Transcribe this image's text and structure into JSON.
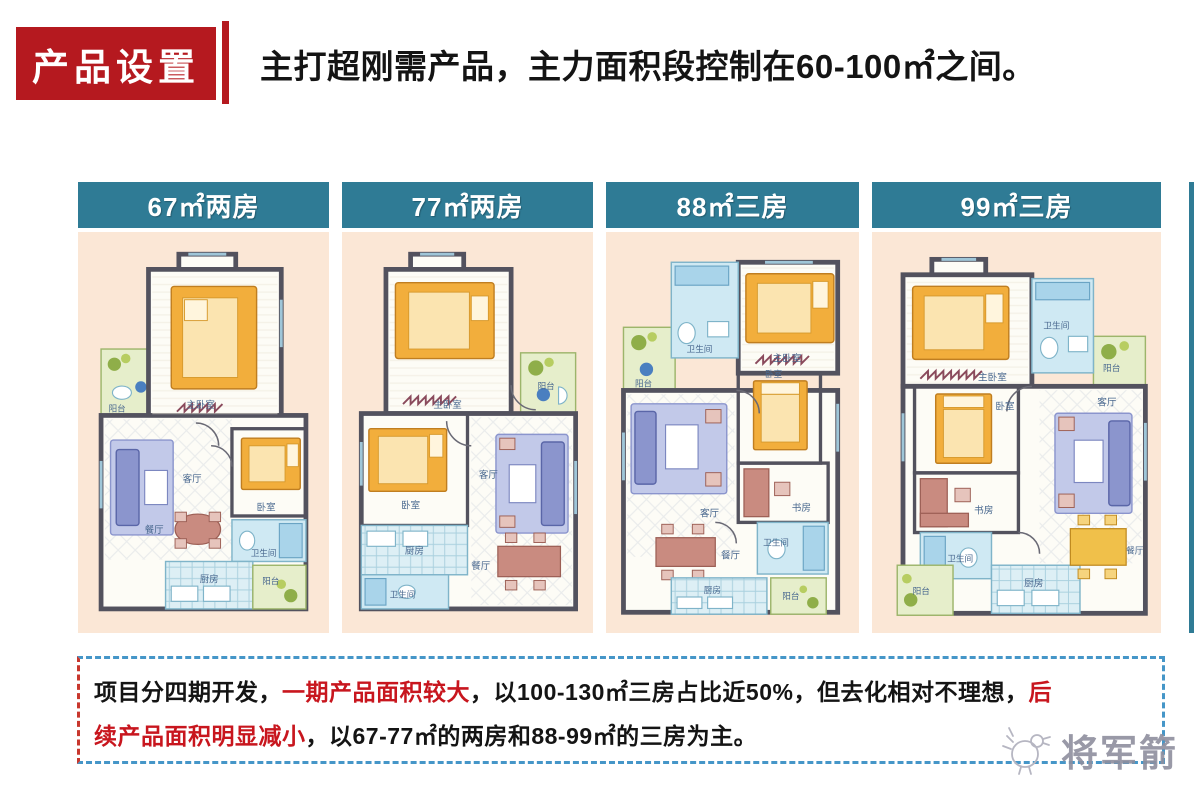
{
  "header": {
    "badge": "产品设置",
    "title": "主打超刚需产品，主力面积段控制在60-100㎡之间。"
  },
  "panels": [
    {
      "header": "67㎡两房"
    },
    {
      "header": "77㎡两房"
    },
    {
      "header": "88㎡三房"
    },
    {
      "header": "99㎡三房"
    }
  ],
  "room_labels": {
    "master": "主卧室",
    "bedroom": "卧室",
    "living": "客厅",
    "dining": "餐厅",
    "kitchen": "厨房",
    "bath": "卫生间",
    "balcony": "阳台",
    "study": "书房"
  },
  "note": {
    "line1": {
      "s1": "项目分四期开发，",
      "s2": "一期产品面积较大",
      "s3": "，以100-130㎡三房占比近50%，但去化相对不理想，",
      "s4": "后"
    },
    "line2": {
      "s1": "续产品面积明显减小",
      "s2": "，以67-77㎡的两房和88-99㎡的三房为主。"
    }
  },
  "watermark": {
    "text": "将军箭"
  },
  "colors": {
    "accent_red": "#b5191f",
    "red_text": "#c8161e",
    "panel_teal": "#2f7b95",
    "panel_bg": "#fbe7d6",
    "note_border_blue": "#4596c8",
    "note_border_left_red": "#c8372d"
  }
}
